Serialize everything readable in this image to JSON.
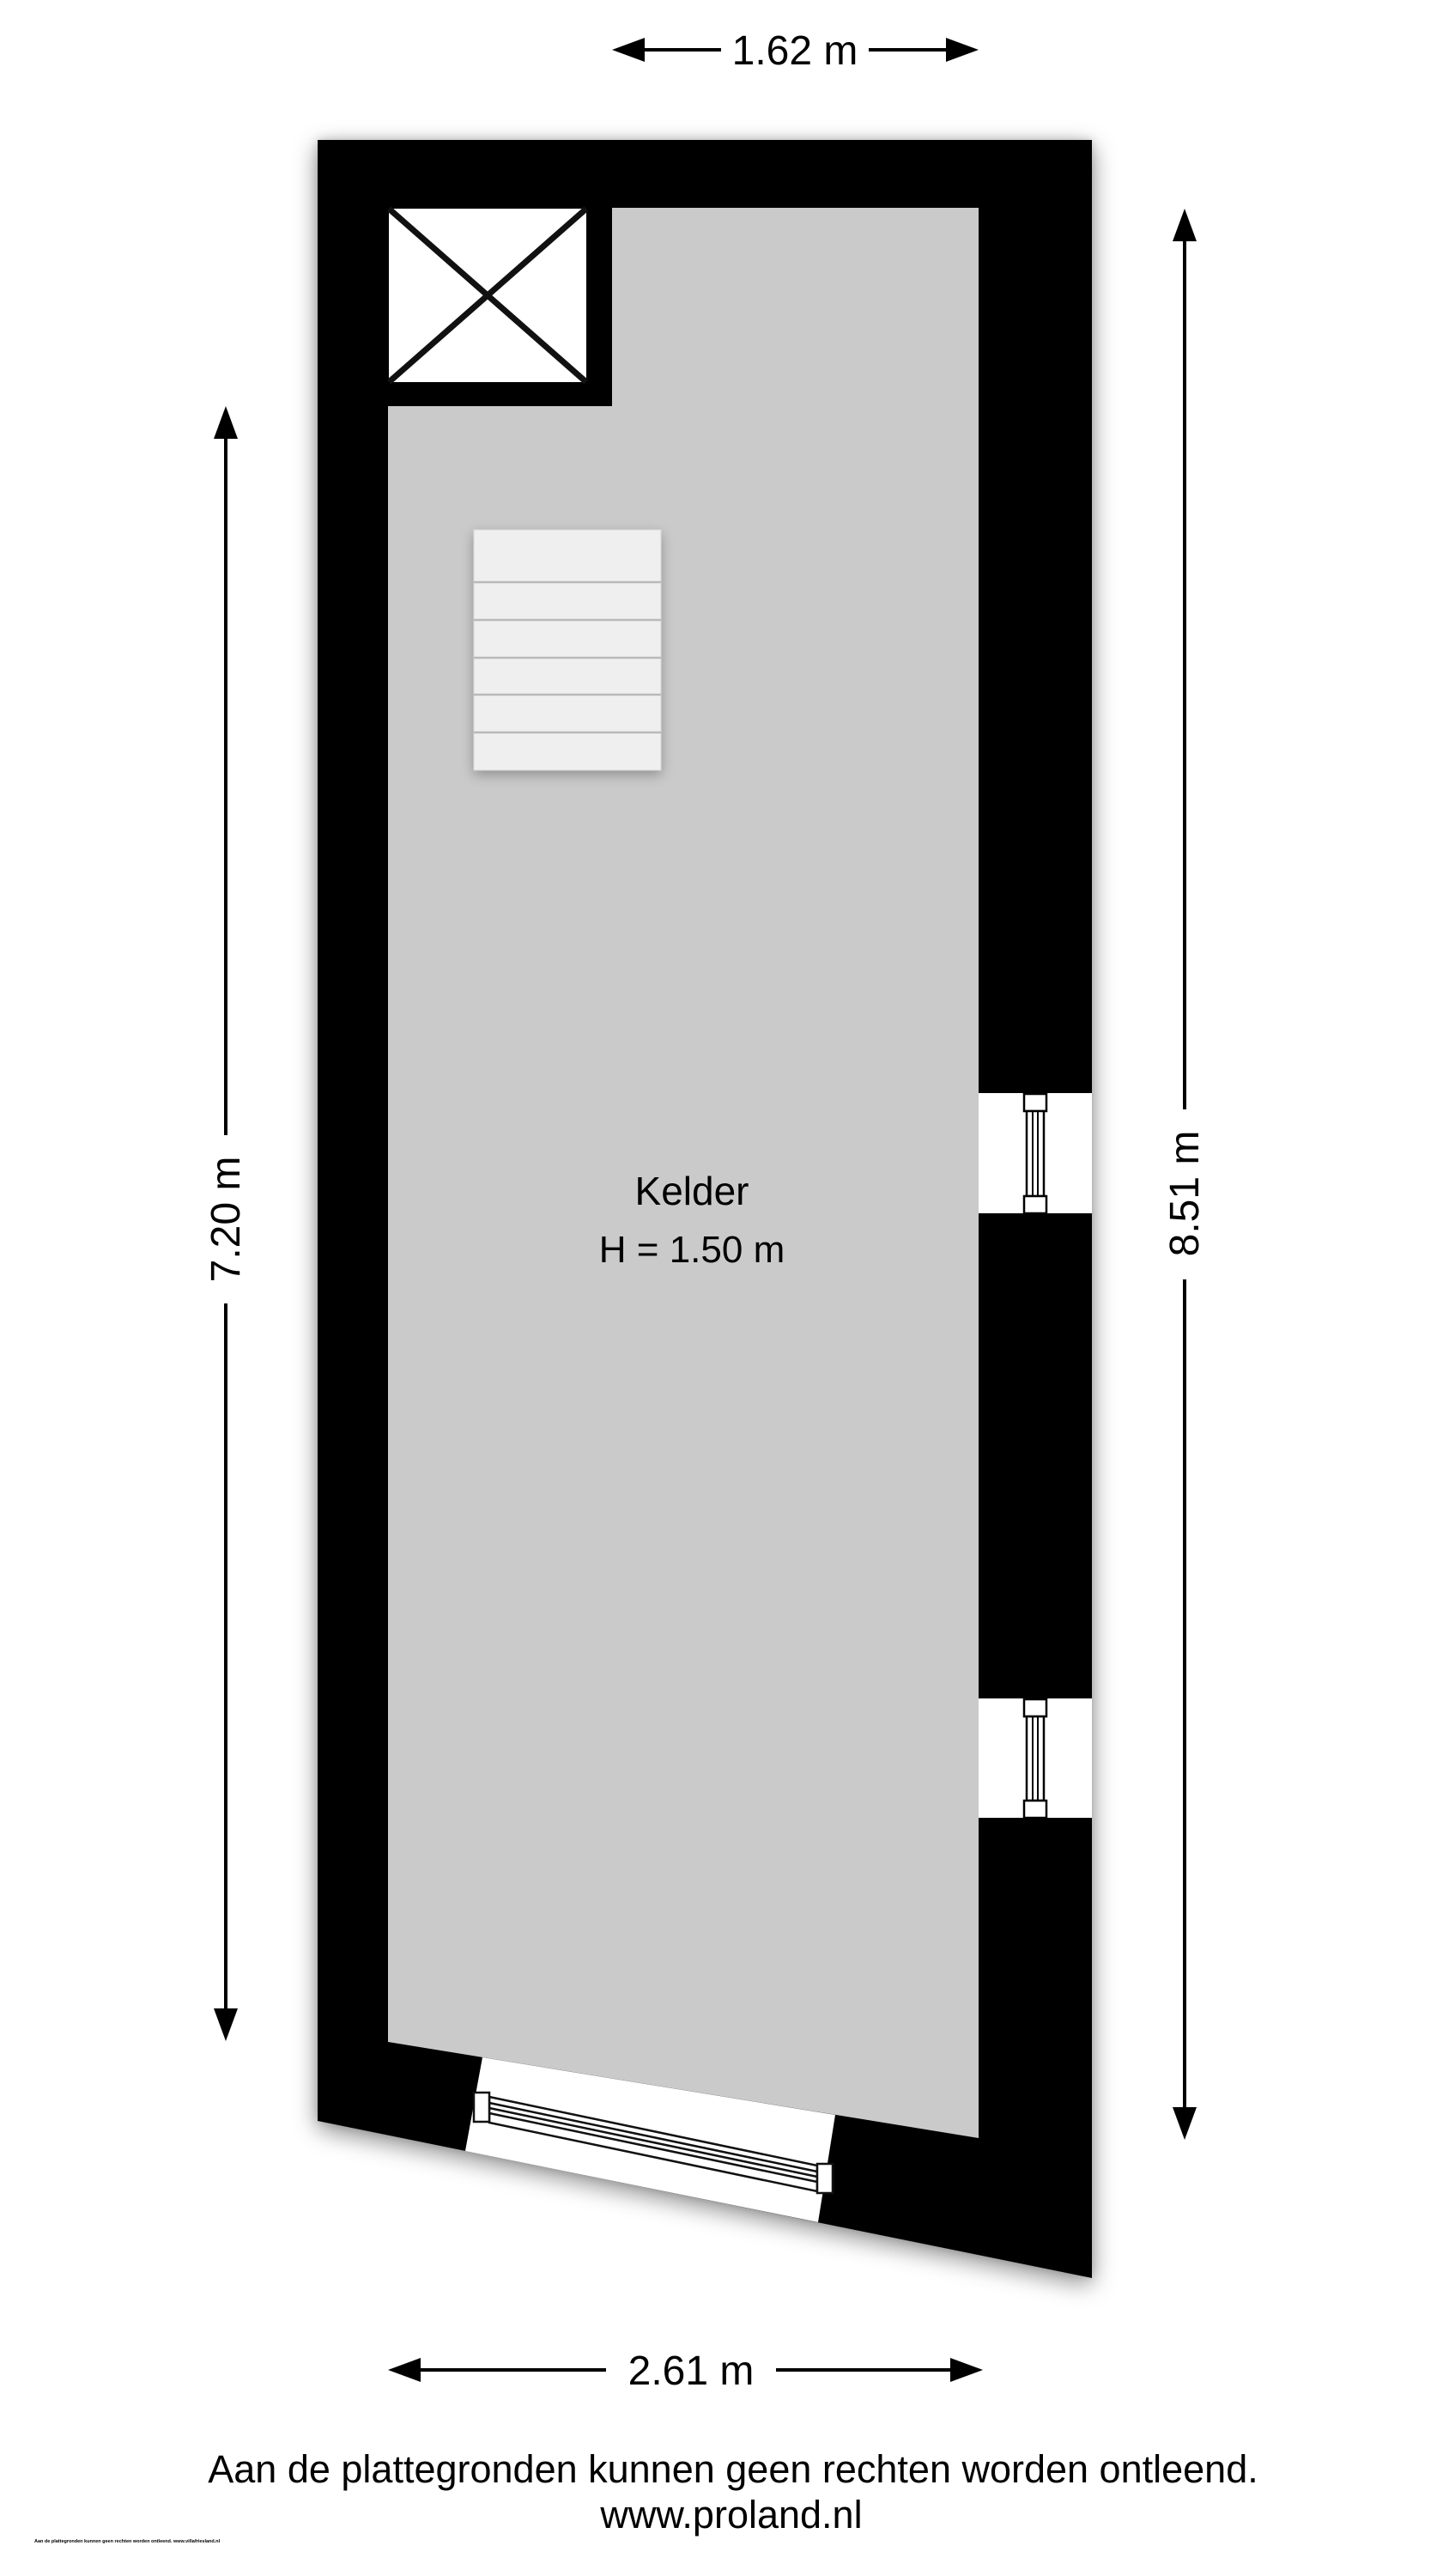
{
  "floor_plan": {
    "room": {
      "name": "Kelder",
      "height": "H = 1.50 m"
    },
    "dimensions": {
      "top": {
        "label": "1.62 m"
      },
      "left": {
        "label": "7.20 m"
      },
      "right": {
        "label": "8.51 m"
      },
      "bottom": {
        "label": "2.61 m"
      }
    },
    "footer": {
      "disclaimer": "Aan de plattegronden kunnen geen rechten worden ontleend.",
      "website": "www.proland.nl",
      "fine_print": "Aan de plattegronden kunnen geen rechten worden ontleend. www.villafriesland.nl"
    },
    "colors": {
      "wall": "#000000",
      "floor": "#cacaca",
      "stairs": "#efefef",
      "stair_line": "#b9b9b9",
      "background": "#ffffff",
      "line": "#111111"
    }
  }
}
